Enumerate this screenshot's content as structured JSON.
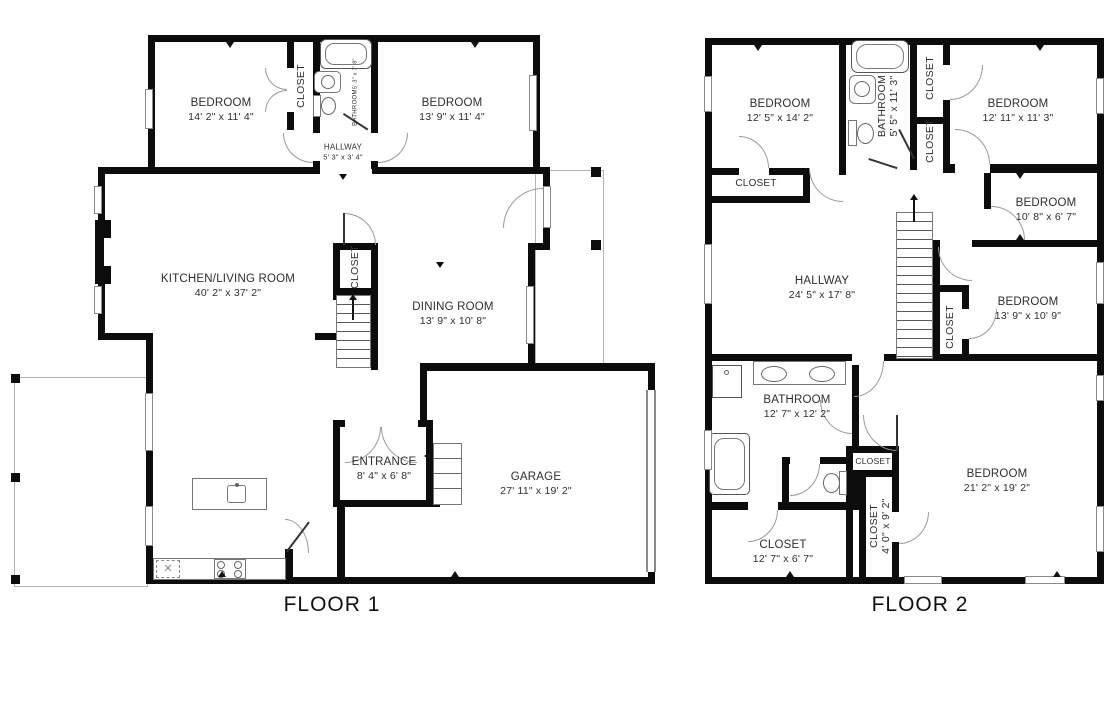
{
  "title": {
    "floor1": "FLOOR 1",
    "floor2": "FLOOR 2"
  },
  "floor1": {
    "bedroom_tl": {
      "name": "BEDROOM",
      "dims": "14' 2\" x 11' 4\""
    },
    "closet_wing": {
      "name": "CLOSET"
    },
    "bathroom": {
      "name": "BATHROOM",
      "dims": "5' 3\" x 7' 8\""
    },
    "bedroom_tr": {
      "name": "BEDROOM",
      "dims": "13' 9\" x 11' 4\""
    },
    "hallway": {
      "name": "HALLWAY",
      "dims": "5' 3\" x 3' 4\""
    },
    "kitchen_living": {
      "name": "KITCHEN/LIVING ROOM",
      "dims": "40' 2\" x 37' 2\""
    },
    "closet_main": {
      "name": "CLOSET"
    },
    "dining_room": {
      "name": "DINING ROOM",
      "dims": "13' 9\" x 10' 8\""
    },
    "entrance": {
      "name": "ENTRANCE",
      "dims": "8' 4\" x 6' 8\""
    },
    "garage": {
      "name": "GARAGE",
      "dims": "27' 11\" x 19' 2\""
    }
  },
  "floor2": {
    "bedroom_tl": {
      "name": "BEDROOM",
      "dims": "12' 5\" x 14' 2\""
    },
    "closet_tl": {
      "name": "CLOSET"
    },
    "bathroom_top": {
      "name": "BATHROOM",
      "dims": "5' 5\" x 11' 3\""
    },
    "closet_top1": {
      "name": "CLOSET"
    },
    "closet_top2": {
      "name": "CLOSET"
    },
    "bedroom_tr": {
      "name": "BEDROOM",
      "dims": "12' 11\" x 11' 3\""
    },
    "bedroom_mr": {
      "name": "BEDROOM",
      "dims": "10' 8\" x 6' 7\""
    },
    "hallway": {
      "name": "HALLWAY",
      "dims": "24' 5\" x 17' 8\""
    },
    "closet_mid": {
      "name": "CLOSET"
    },
    "bedroom_r": {
      "name": "BEDROOM",
      "dims": "13' 9\" x 10' 9\""
    },
    "bathroom_bottom": {
      "name": "BATHROOM",
      "dims": "12' 7\" x 12' 2\""
    },
    "closet_small": {
      "name": "CLOSET"
    },
    "closet_tall": {
      "name": "CLOSET",
      "dims": "4' 0\" x 9' 2\""
    },
    "closet_bl": {
      "name": "CLOSET",
      "dims": "12' 7\" x 6' 7\""
    },
    "bedroom_br": {
      "name": "BEDROOM",
      "dims": "21' 2\" x 19' 2\""
    }
  }
}
